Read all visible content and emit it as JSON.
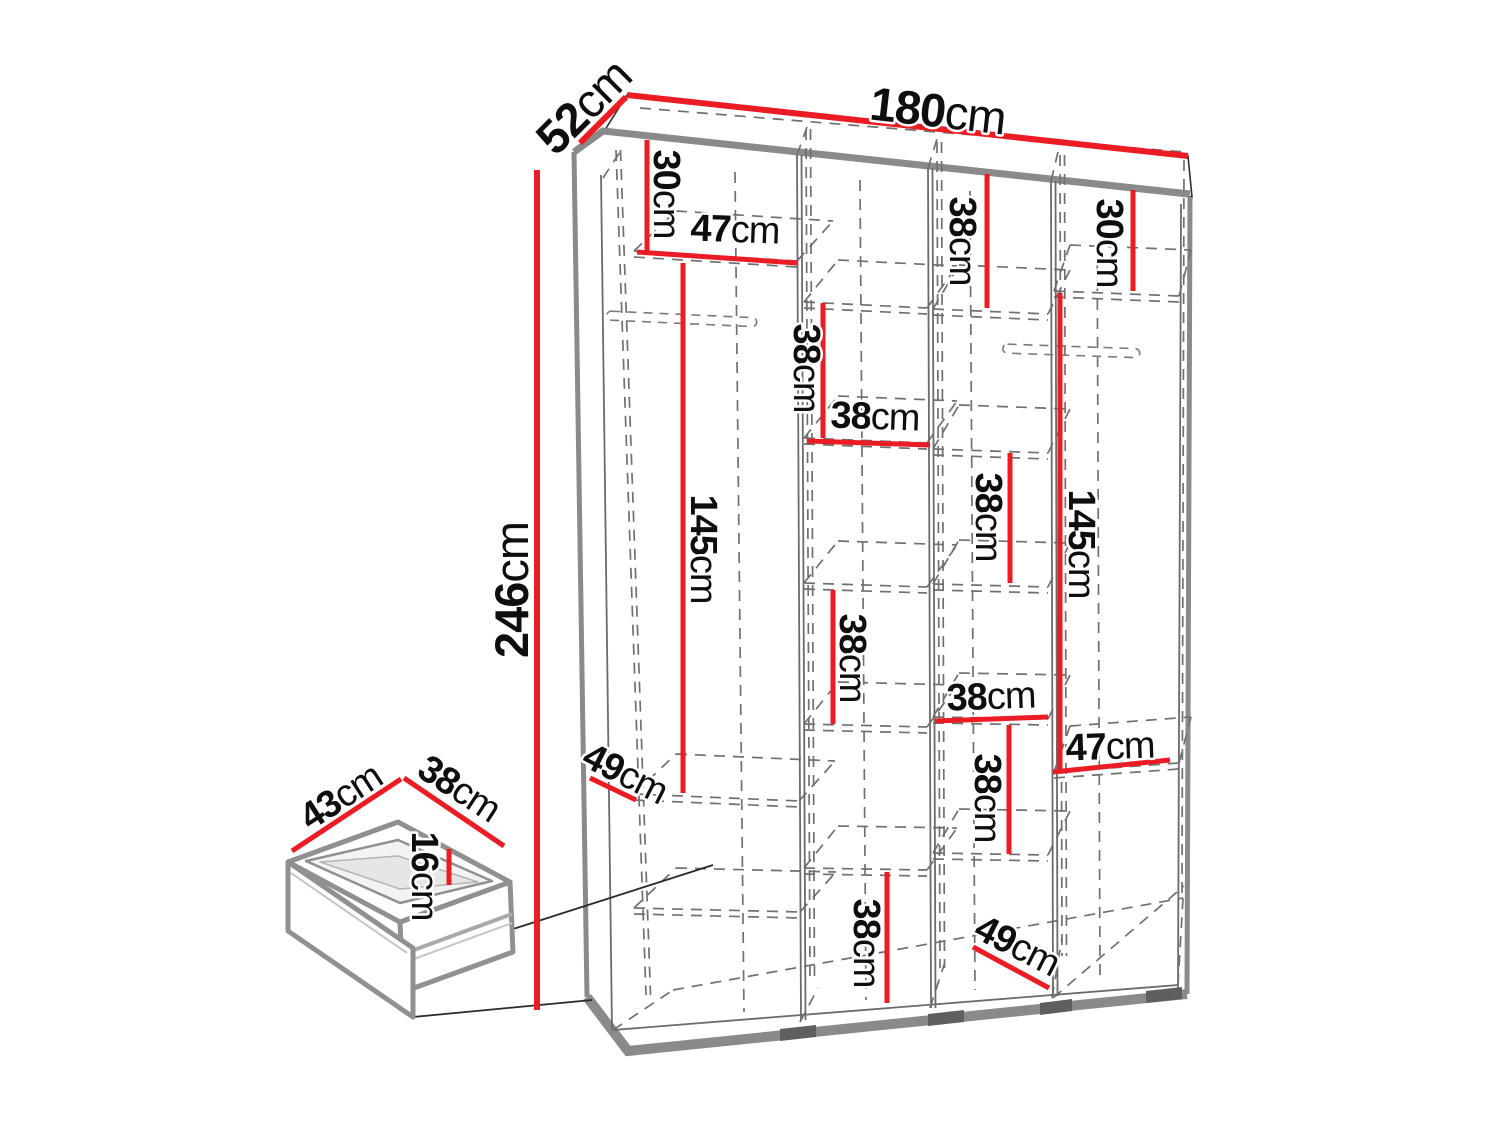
{
  "colors": {
    "dimension_red": "#ec1c24",
    "outline_gray": "#8a8a8a"
  },
  "dims": {
    "overall": {
      "width": {
        "value": "180",
        "unit": "cm"
      },
      "depth": {
        "value": "52",
        "unit": "cm"
      },
      "height": {
        "value": "246",
        "unit": "cm"
      }
    },
    "sections": {
      "s1_top": {
        "value": "30",
        "unit": "cm"
      },
      "s1_width": {
        "value": "47",
        "unit": "cm"
      },
      "s1_hanging": {
        "value": "145",
        "unit": "cm"
      },
      "s1_depth": {
        "value": "49",
        "unit": "cm"
      },
      "s2_top": {
        "value": "38",
        "unit": "cm"
      },
      "s2_width": {
        "value": "38",
        "unit": "cm"
      },
      "s2_mid": {
        "value": "38",
        "unit": "cm"
      },
      "s2_bottom": {
        "value": "38",
        "unit": "cm"
      },
      "s3_top": {
        "value": "38",
        "unit": "cm"
      },
      "s3_upper": {
        "value": "38",
        "unit": "cm"
      },
      "s3_width": {
        "value": "38",
        "unit": "cm"
      },
      "s3_lower": {
        "value": "38",
        "unit": "cm"
      },
      "s3_depth": {
        "value": "49",
        "unit": "cm"
      },
      "s4_top": {
        "value": "30",
        "unit": "cm"
      },
      "s4_hanging": {
        "value": "145",
        "unit": "cm"
      },
      "s4_width": {
        "value": "47",
        "unit": "cm"
      }
    },
    "drawer": {
      "width": {
        "value": "43",
        "unit": "cm"
      },
      "depth": {
        "value": "38",
        "unit": "cm"
      },
      "height": {
        "value": "16",
        "unit": "cm"
      }
    }
  }
}
